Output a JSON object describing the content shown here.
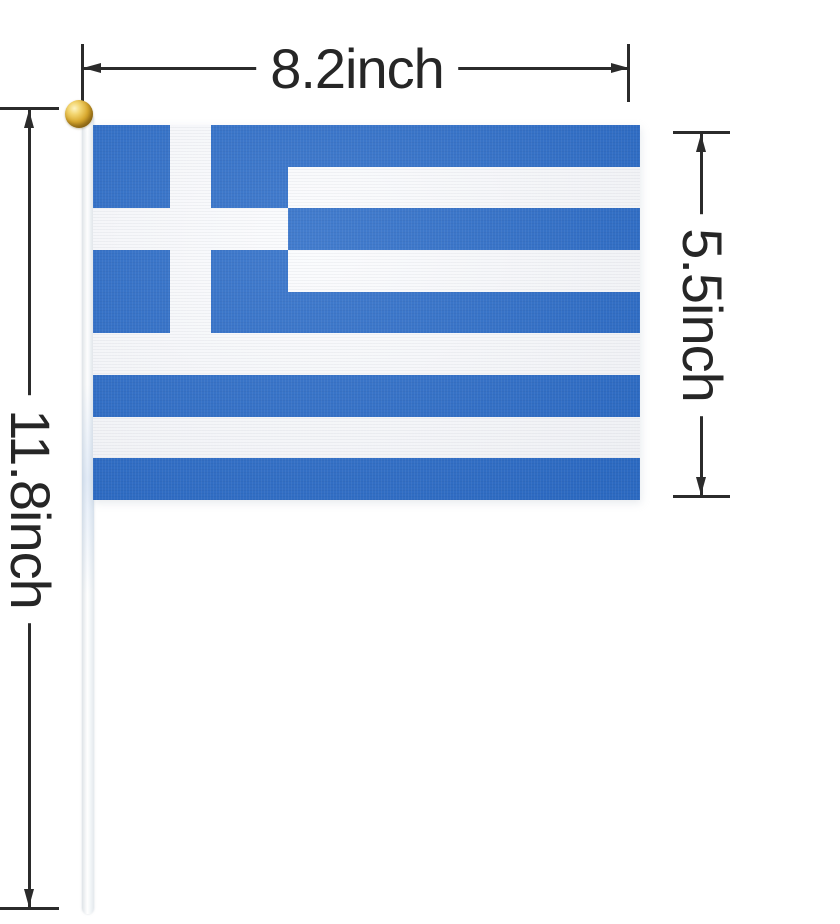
{
  "image": {
    "type": "product-dimension-diagram",
    "background_color": "#ffffff",
    "annotation_line_color": "#2b2b2b"
  },
  "annotations": {
    "width_label": "8.2inch",
    "height_label": "5.5inch",
    "pole_length_label": "11.8inch"
  },
  "flag": {
    "country": "Greece",
    "stripe_count": 9,
    "colors": {
      "blue": "#2e6ec8",
      "white": "#fbfcfe"
    },
    "pole": {
      "color": "#f6f8fa",
      "finial": "gold ball"
    }
  }
}
